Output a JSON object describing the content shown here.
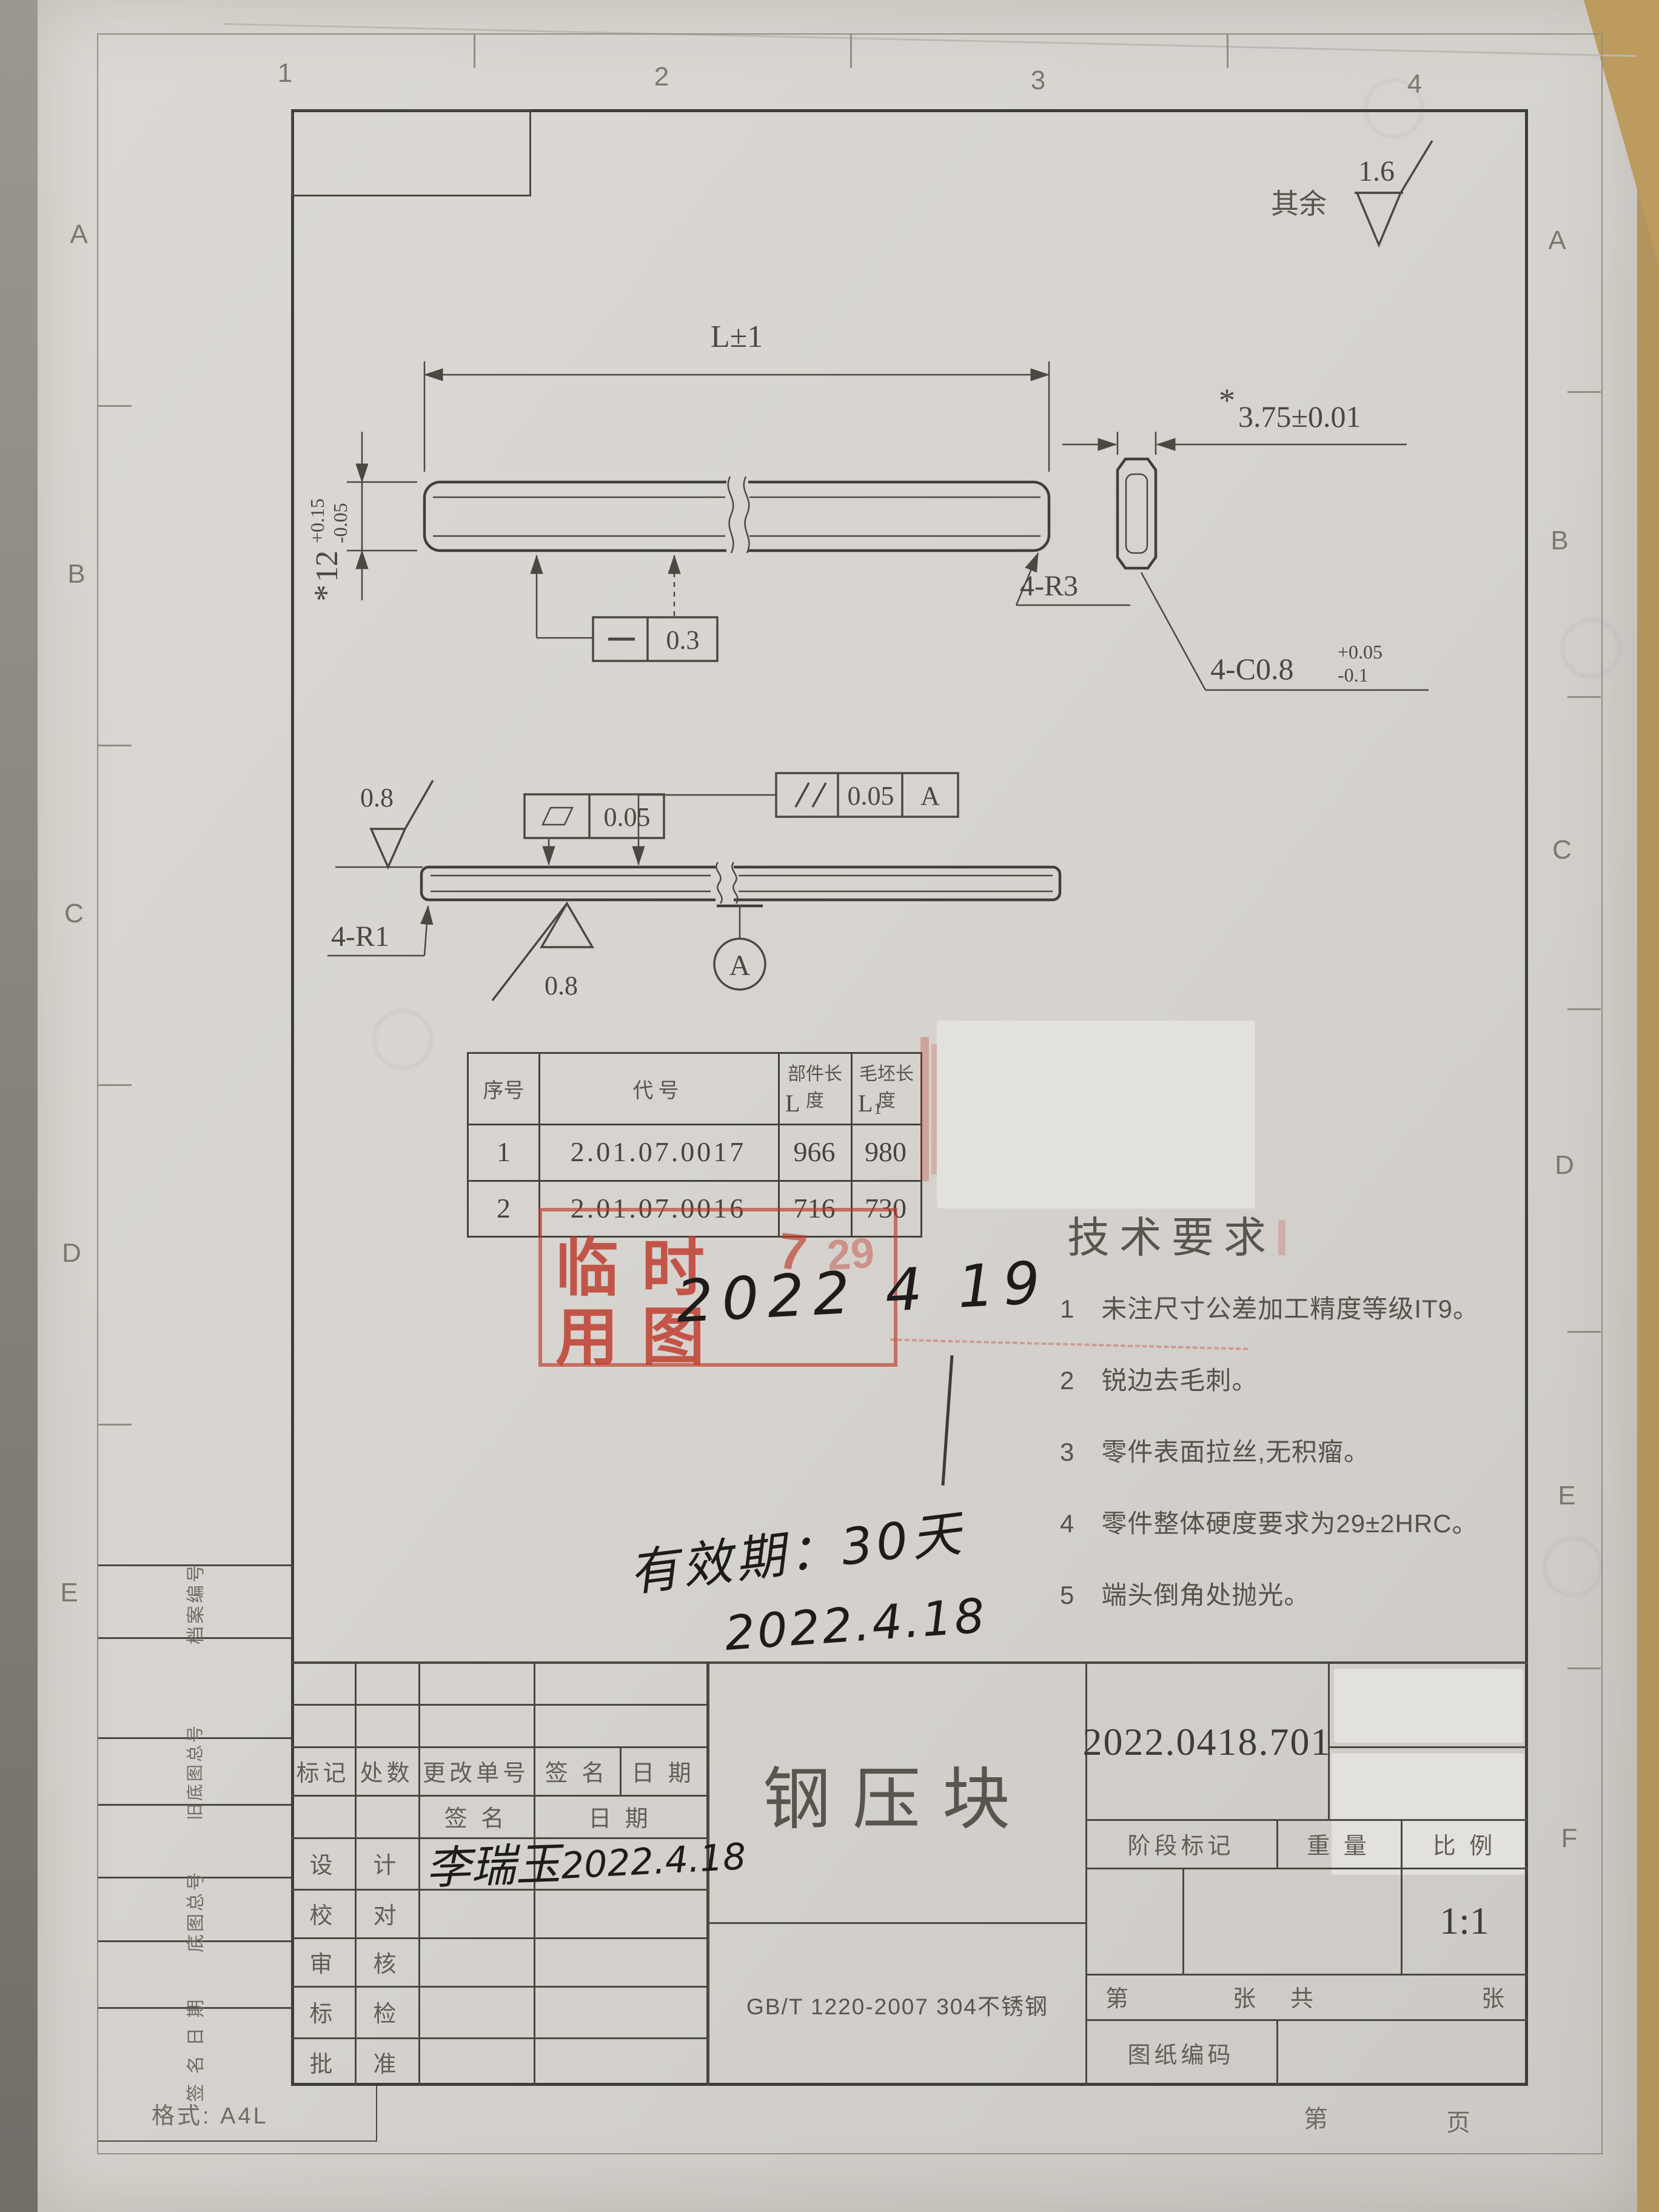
{
  "colors": {
    "paper": "#d8d5d0",
    "line": "#45443f",
    "red": "#bd392b",
    "ink": "#1d1c1a",
    "desk": "#b3945c"
  },
  "frame": {
    "grid_top": [
      "1",
      "2",
      "3",
      "4"
    ],
    "grid_left": [
      "A",
      "B",
      "C",
      "D",
      "E"
    ],
    "grid_right": [
      "A",
      "B",
      "C",
      "D",
      "E",
      "F"
    ],
    "format_note": "格式: A4L",
    "page_prefix": "第",
    "page_suffix": "页"
  },
  "surface_default": {
    "label": "其余",
    "value": "1.6"
  },
  "top_view": {
    "length_dim": "L±1",
    "width_star": "*",
    "width_value": "12",
    "width_tol_upper": "+0.15",
    "width_tol_lower": "-0.05",
    "straightness_value": "0.3",
    "corner_radius_label": "4-R3"
  },
  "end_view": {
    "thickness_star": "*",
    "thickness_dim": "3.75±0.01",
    "chamfer_label": "4-C0.8",
    "chamfer_tol_upper": "+0.05",
    "chamfer_tol_lower": "-0.1"
  },
  "side_view": {
    "flatness_value": "0.05",
    "parallelism_value": "0.05",
    "parallelism_datum": "A",
    "roughness_top": "0.8",
    "roughness_bottom": "0.8",
    "corner_radius_label": "4-R1",
    "datum_label": "A"
  },
  "parts_table": {
    "col_seq": "序号",
    "col_code": "代号",
    "col_part_len": "部件长度",
    "col_part_len_sym": "L",
    "col_blank_len": "毛坯长度",
    "col_blank_len_sym": "L",
    "col_blank_len_sub": "1",
    "rows": [
      {
        "seq": "1",
        "code": "2.01.07.0017",
        "part_len": "966",
        "blank_len": "980"
      },
      {
        "seq": "2",
        "code": "2.01.07.0016",
        "part_len": "716",
        "blank_len": "730"
      }
    ]
  },
  "stamp": {
    "char_1": "临",
    "char_2": "时",
    "char_3": "用",
    "char_4": "图",
    "red_mark_1": "7",
    "red_mark_2": "29",
    "written_date": "2022 4 19"
  },
  "tech_req": {
    "title": "技术要求",
    "items": [
      {
        "num": "1",
        "text": "未注尺寸公差加工精度等级IT9。"
      },
      {
        "num": "2",
        "text": "锐边去毛刺。"
      },
      {
        "num": "3",
        "text": "零件表面拉丝,无积瘤。"
      },
      {
        "num": "4",
        "text": "零件整体硬度要求为29±2HRC。"
      },
      {
        "num": "5",
        "text": "端头倒角处抛光。"
      }
    ]
  },
  "notes": {
    "validity": "有效期：30天",
    "validity_date": "2022.4.18"
  },
  "title_block": {
    "rev_h1": "标记",
    "rev_h2": "处数",
    "rev_h3": "更改单号",
    "rev_h4": "签 名",
    "rev_h5": "日 期",
    "sub_sign": "签 名",
    "sub_date": "日 期",
    "staff": [
      {
        "role_a": "设",
        "role_b": "计",
        "sign": "李瑞玉",
        "date": "2022.4.18"
      },
      {
        "role_a": "校",
        "role_b": "对",
        "sign": "",
        "date": ""
      },
      {
        "role_a": "审",
        "role_b": "核",
        "sign": "",
        "date": ""
      },
      {
        "role_a": "标",
        "role_b": "检",
        "sign": "",
        "date": ""
      },
      {
        "role_a": "批",
        "role_b": "准",
        "sign": "",
        "date": ""
      }
    ],
    "part_title": "钢压块",
    "drawing_no": "2022.0418.701",
    "stage_label": "阶段标记",
    "weight_label": "重 量",
    "scale_label": "比 例",
    "scale_value": "1:1",
    "sheet_l1": "第",
    "sheet_l2": "张",
    "sheet_l3": "共",
    "sheet_l4": "张",
    "code_label": "图纸编码",
    "material": "GB/T 1220-2007 304不锈钢",
    "margin_label_1": "档案编号",
    "margin_label_2": "旧底图总号",
    "margin_label_3": "底图总号",
    "margin_label_4": "签 名  日 期"
  }
}
